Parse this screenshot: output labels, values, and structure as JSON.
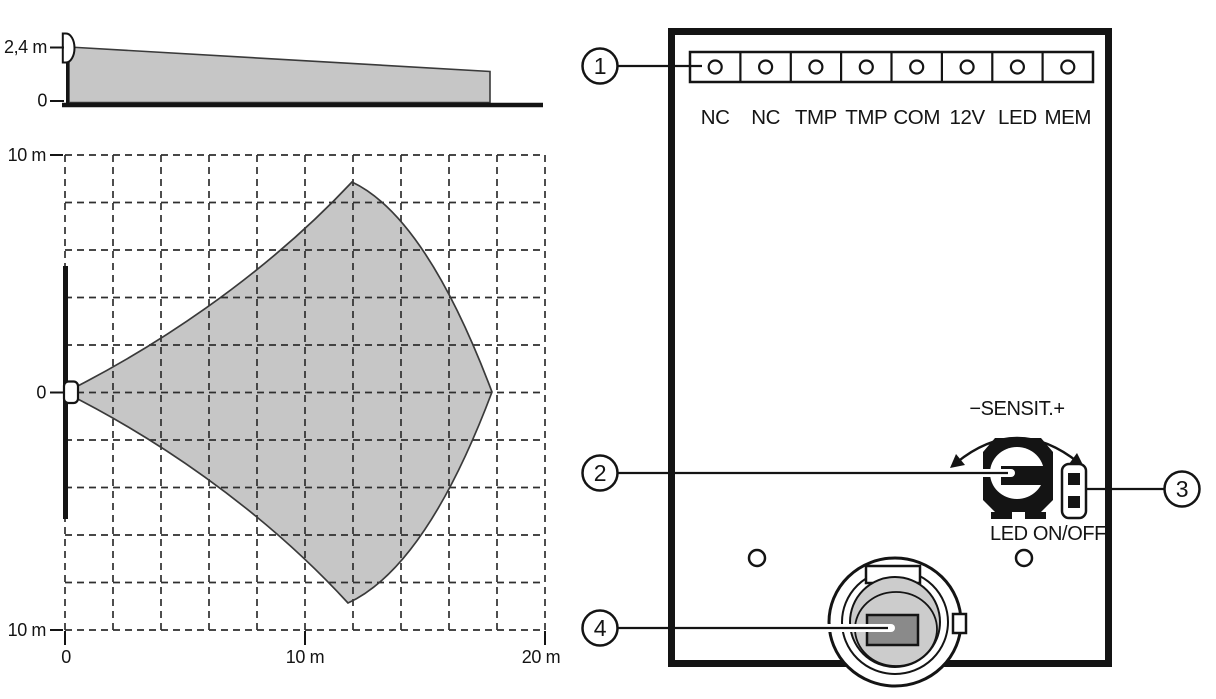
{
  "figure_title": "PIR detector coverage and PCB layout diagram",
  "pcb": {
    "terminals": [
      "NC",
      "NC",
      "TMP",
      "TMP",
      "COM",
      "12V",
      "LED",
      "MEM"
    ],
    "sensitivity_label": "−SENSIT.+",
    "led_jumper_label": "LED ON/OFF"
  },
  "callouts": [
    "1",
    "2",
    "3",
    "4"
  ],
  "colors": {
    "coverage_fill": "#c6c6c6",
    "sensor_window_fill": "#cccccc",
    "pyro_element_fill": "#8a8a8a",
    "line": "#141414"
  },
  "chart_data": [
    {
      "type": "area",
      "name": "side-view-coverage",
      "y_tick_labels": [
        "2,4 m",
        "0"
      ],
      "y_range_m": [
        0,
        2.4
      ],
      "x_range_m": [
        0,
        20
      ],
      "mount_height_m": 2.4,
      "max_range_m": 18,
      "coverage_polygon_m": [
        [
          0,
          2.4
        ],
        [
          18,
          1.35
        ],
        [
          18,
          0
        ],
        [
          0,
          0
        ]
      ],
      "grid": false
    },
    {
      "type": "area",
      "name": "top-view-coverage",
      "x_tick_labels": [
        "0",
        "10 m",
        "20 m"
      ],
      "y_tick_labels": [
        "10 m",
        "0",
        "10 m"
      ],
      "x_range_m": [
        0,
        20
      ],
      "y_range_m": [
        -10,
        10
      ],
      "grid": true,
      "grid_step_m": 2,
      "max_range_m": 18,
      "beam_half_width_max_m": 9,
      "coverage_vertices_m": [
        [
          0,
          0
        ],
        [
          12,
          9
        ],
        [
          18,
          0
        ],
        [
          12,
          -9
        ]
      ]
    }
  ]
}
